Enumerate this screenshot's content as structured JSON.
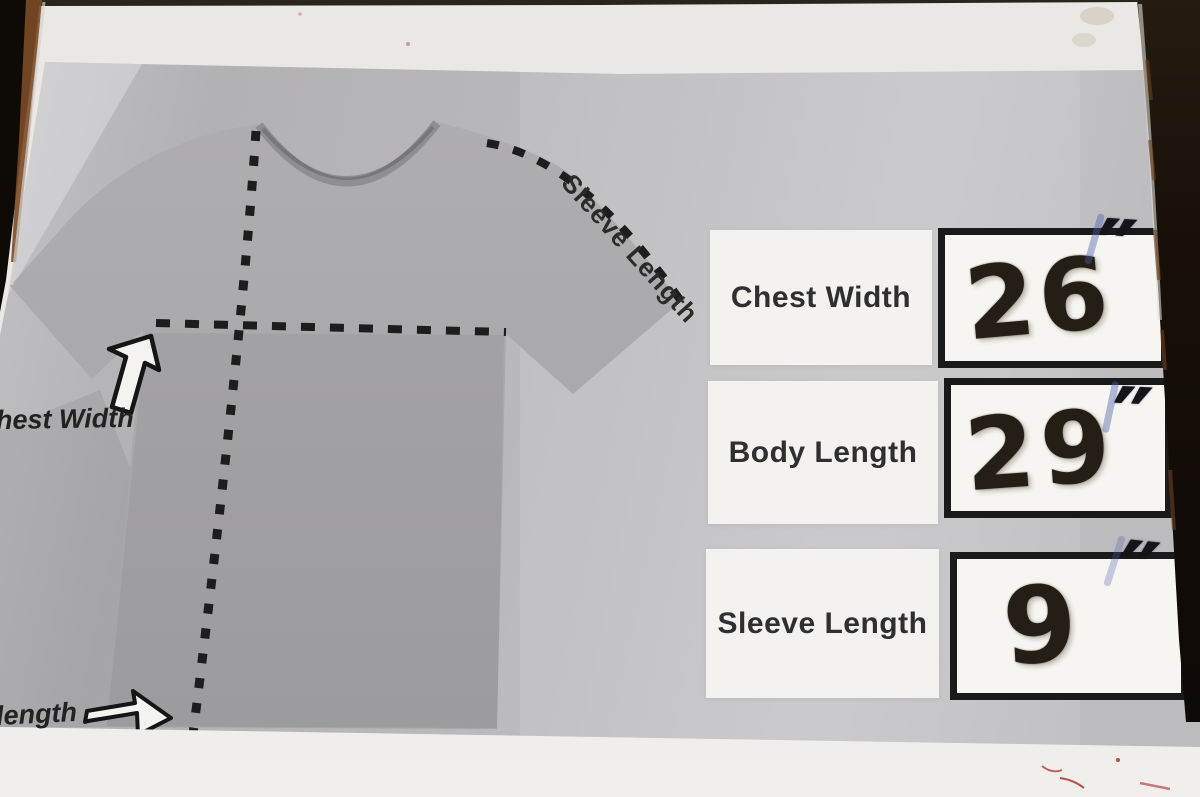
{
  "diagram": {
    "sleeve_length_line_label": "Sleeve Length",
    "chest_width_edge_label": "hest Width",
    "body_length_edge_label": "length"
  },
  "size_table": {
    "rows": [
      {
        "label": "Chest Width",
        "value": "26",
        "unit": "″"
      },
      {
        "label": "Body Length",
        "value": "29",
        "unit": "″"
      },
      {
        "label": "Sleeve Length",
        "value": "9",
        "unit": "″"
      }
    ]
  },
  "colors": {
    "paper": "#edebe7",
    "panel_gray": "#b7b6b9",
    "shirt_gray": "#a9a8ab",
    "ink_black": "#1d1d1d",
    "marker_ink": "#251e14",
    "blue_ink": "#4860aa",
    "frame_dark": "#120d08",
    "frame_brown": "#7c4a27",
    "label_box_bg": "#f3f2ef",
    "value_box_bg": "#f6f5f2",
    "red_marks": "#b5524e"
  }
}
